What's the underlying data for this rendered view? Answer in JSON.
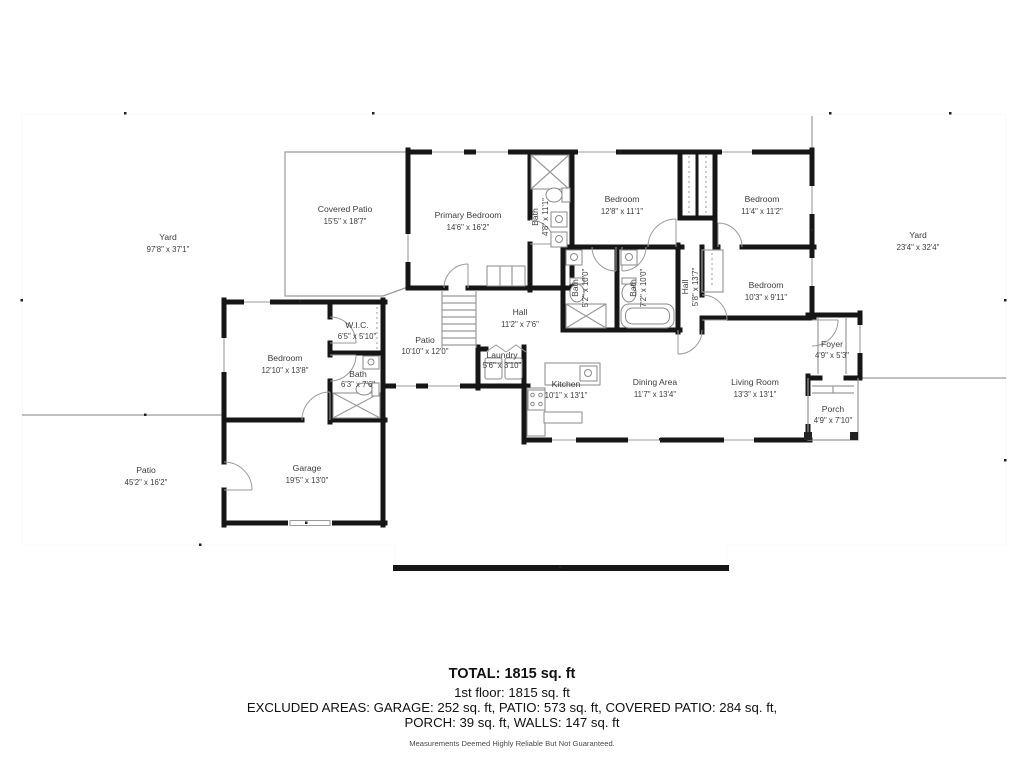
{
  "plan": {
    "wall_color": "#161616",
    "line_color": "#9a9a9a",
    "text_color": "#3d3d3d",
    "rooms": [
      {
        "name": "Yard",
        "dims": "97'8\" x 37'1\""
      },
      {
        "name": "Covered Patio",
        "dims": "15'5\" x 18'7\""
      },
      {
        "name": "Primary Bedroom",
        "dims": "14'6\" x 16'2\""
      },
      {
        "name": "Bath",
        "dims": "4'8\" x 11'1\""
      },
      {
        "name": "Bedroom",
        "dims": "12'8\" x 11'1\""
      },
      {
        "name": "Bedroom",
        "dims": "11'4\" x 11'2\""
      },
      {
        "name": "Yard",
        "dims": "23'4\" x 32'4\""
      },
      {
        "name": "Bath",
        "dims": "5'2\" x 10'0\""
      },
      {
        "name": "Bath",
        "dims": "7'2\" x 10'0\""
      },
      {
        "name": "Hall",
        "dims": "5'8\" x 13'7\""
      },
      {
        "name": "Bedroom",
        "dims": "10'3\" x 9'11\""
      },
      {
        "name": "W.I.C.",
        "dims": "6'5\" x 5'10\""
      },
      {
        "name": "Patio",
        "dims": "10'10\" x 12'0\""
      },
      {
        "name": "Hall",
        "dims": "11'2\" x 7'6\""
      },
      {
        "name": "Bedroom",
        "dims": "12'10\" x 13'8\""
      },
      {
        "name": "Laundry",
        "dims": "5'6\" x 3'10\""
      },
      {
        "name": "Bath",
        "dims": "6'3\" x 7'6\""
      },
      {
        "name": "Kitchen",
        "dims": "10'1\" x 13'1\""
      },
      {
        "name": "Dining Area",
        "dims": "11'7\" x 13'4\""
      },
      {
        "name": "Living Room",
        "dims": "13'3\" x 13'1\""
      },
      {
        "name": "Foyer",
        "dims": "4'9\" x 5'3\""
      },
      {
        "name": "Porch",
        "dims": "4'9\" x 7'10\""
      },
      {
        "name": "Patio",
        "dims": "45'2\" x 16'2\""
      },
      {
        "name": "Garage",
        "dims": "19'5\" x 13'0\""
      }
    ]
  },
  "summary": {
    "total": "TOTAL: 1815 sq. ft",
    "floor1": "1st floor: 1815 sq. ft",
    "excluded_line1": "EXCLUDED AREAS: GARAGE: 252 sq. ft, PATIO: 573 sq. ft, COVERED PATIO: 284 sq. ft,",
    "excluded_line2": "PORCH: 39 sq. ft, WALLS: 147 sq. ft",
    "disclaimer": "Measurements Deemed Highly Reliable But Not Guaranteed."
  }
}
